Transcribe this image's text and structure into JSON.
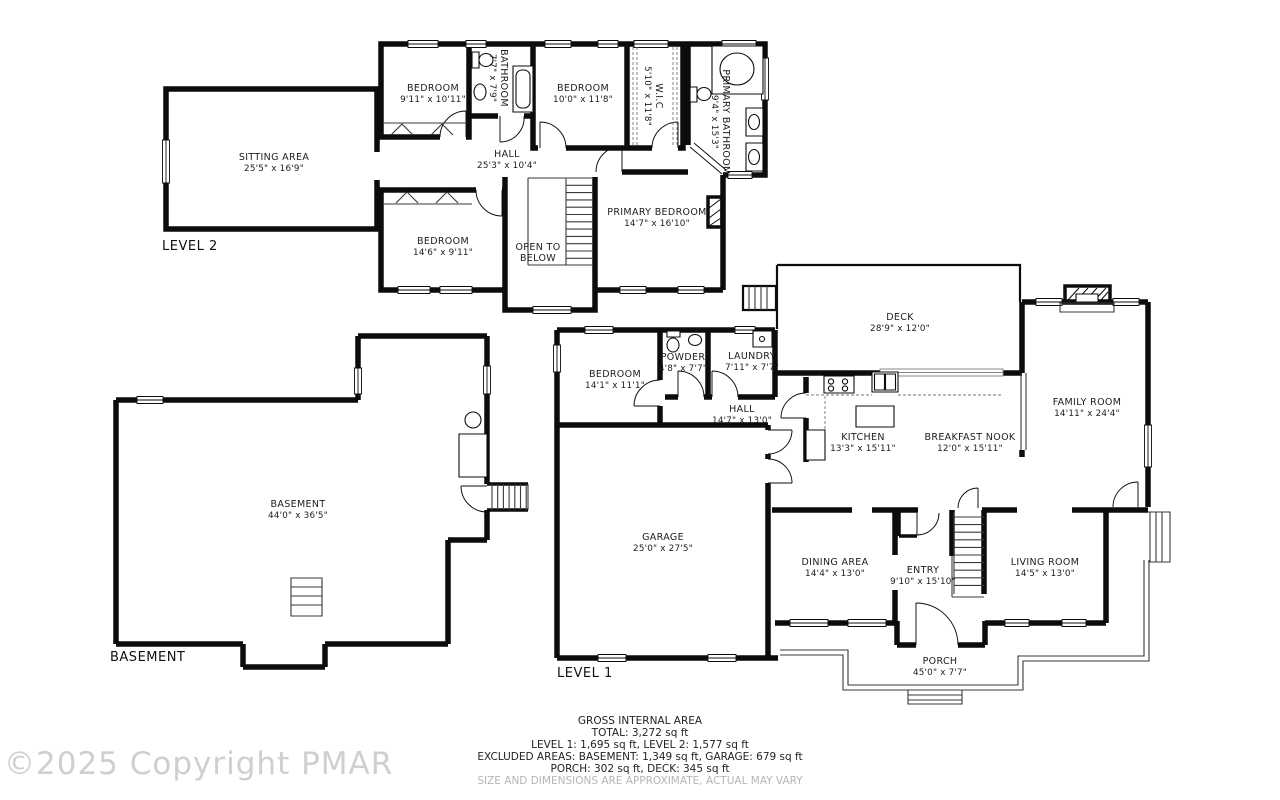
{
  "watermark": "©2025 Copyright PMAR",
  "colors": {
    "wall": "#0c0c0c",
    "label": "#1d1d1d",
    "muted": "#b5b5b5",
    "watermark": "#cfcfcf",
    "background": "#ffffff"
  },
  "l2": {
    "label": "LEVEL 2",
    "sitting": {
      "name": "SITTING AREA",
      "dims": "25'5\" x 16'9\""
    },
    "bedroom_a": {
      "name": "BEDROOM",
      "dims": "9'11\" x 10'11\""
    },
    "bathroom": {
      "name": "BATHROOM",
      "dims": "7'7\" x 7'9\""
    },
    "bedroom_b": {
      "name": "BEDROOM",
      "dims": "10'0\" x 11'8\""
    },
    "wic": {
      "name": "W.I.C",
      "dims": "5'10\" x 11'8\""
    },
    "primary_bathroom": {
      "name": "PRIMARY BATHROOM",
      "dims": "9'4\" x 15'3\""
    },
    "hall": {
      "name": "HALL",
      "dims": "25'3\" x 10'4\""
    },
    "bedroom_c": {
      "name": "BEDROOM",
      "dims": "14'6\" x 9'11\""
    },
    "open_below": {
      "line1": "OPEN TO",
      "line2": "BELOW"
    },
    "primary_bedroom": {
      "name": "PRIMARY BEDROOM",
      "dims": "14'7\" x 16'10\""
    }
  },
  "l1": {
    "label": "LEVEL 1",
    "deck": {
      "name": "DECK",
      "dims": "28'9\" x 12'0\""
    },
    "family": {
      "name": "FAMILY ROOM",
      "dims": "14'11\" x 24'4\""
    },
    "bedroom": {
      "name": "BEDROOM",
      "dims": "14'1\" x 11'1\""
    },
    "powder": {
      "name": "POWDER",
      "dims": "4'8\" x 7'7\""
    },
    "laundry": {
      "name": "LAUNDRY",
      "dims": "7'11\" x 7'7\""
    },
    "hall": {
      "name": "HALL",
      "dims": "14'7\" x 13'0\""
    },
    "kitchen": {
      "name": "KITCHEN",
      "dims": "13'3\" x 15'11\""
    },
    "nook": {
      "name": "BREAKFAST NOOK",
      "dims": "12'0\" x 15'11\""
    },
    "garage": {
      "name": "GARAGE",
      "dims": "25'0\" x 27'5\""
    },
    "dining": {
      "name": "DINING AREA",
      "dims": "14'4\" x 13'0\""
    },
    "entry": {
      "name": "ENTRY",
      "dims": "9'10\" x 15'10\""
    },
    "living": {
      "name": "LIVING ROOM",
      "dims": "14'5\" x 13'0\""
    },
    "porch": {
      "name": "PORCH",
      "dims": "45'0\" x 7'7\""
    }
  },
  "basement": {
    "label": "BASEMENT",
    "room": {
      "name": "BASEMENT",
      "dims": "44'0\" x 36'5\""
    }
  },
  "summary": {
    "title": "GROSS INTERNAL AREA",
    "total": "TOTAL: 3,272 sq ft",
    "levels": "LEVEL 1: 1,695 sq ft, LEVEL 2: 1,577 sq ft",
    "excluded": "EXCLUDED AREAS: BASEMENT: 1,349 sq ft, GARAGE: 679 sq ft",
    "porch_deck": "PORCH: 302 sq ft, DECK: 345 sq ft",
    "disclaimer": "SIZE AND DIMENSIONS ARE APPROXIMATE, ACTUAL MAY VARY"
  }
}
